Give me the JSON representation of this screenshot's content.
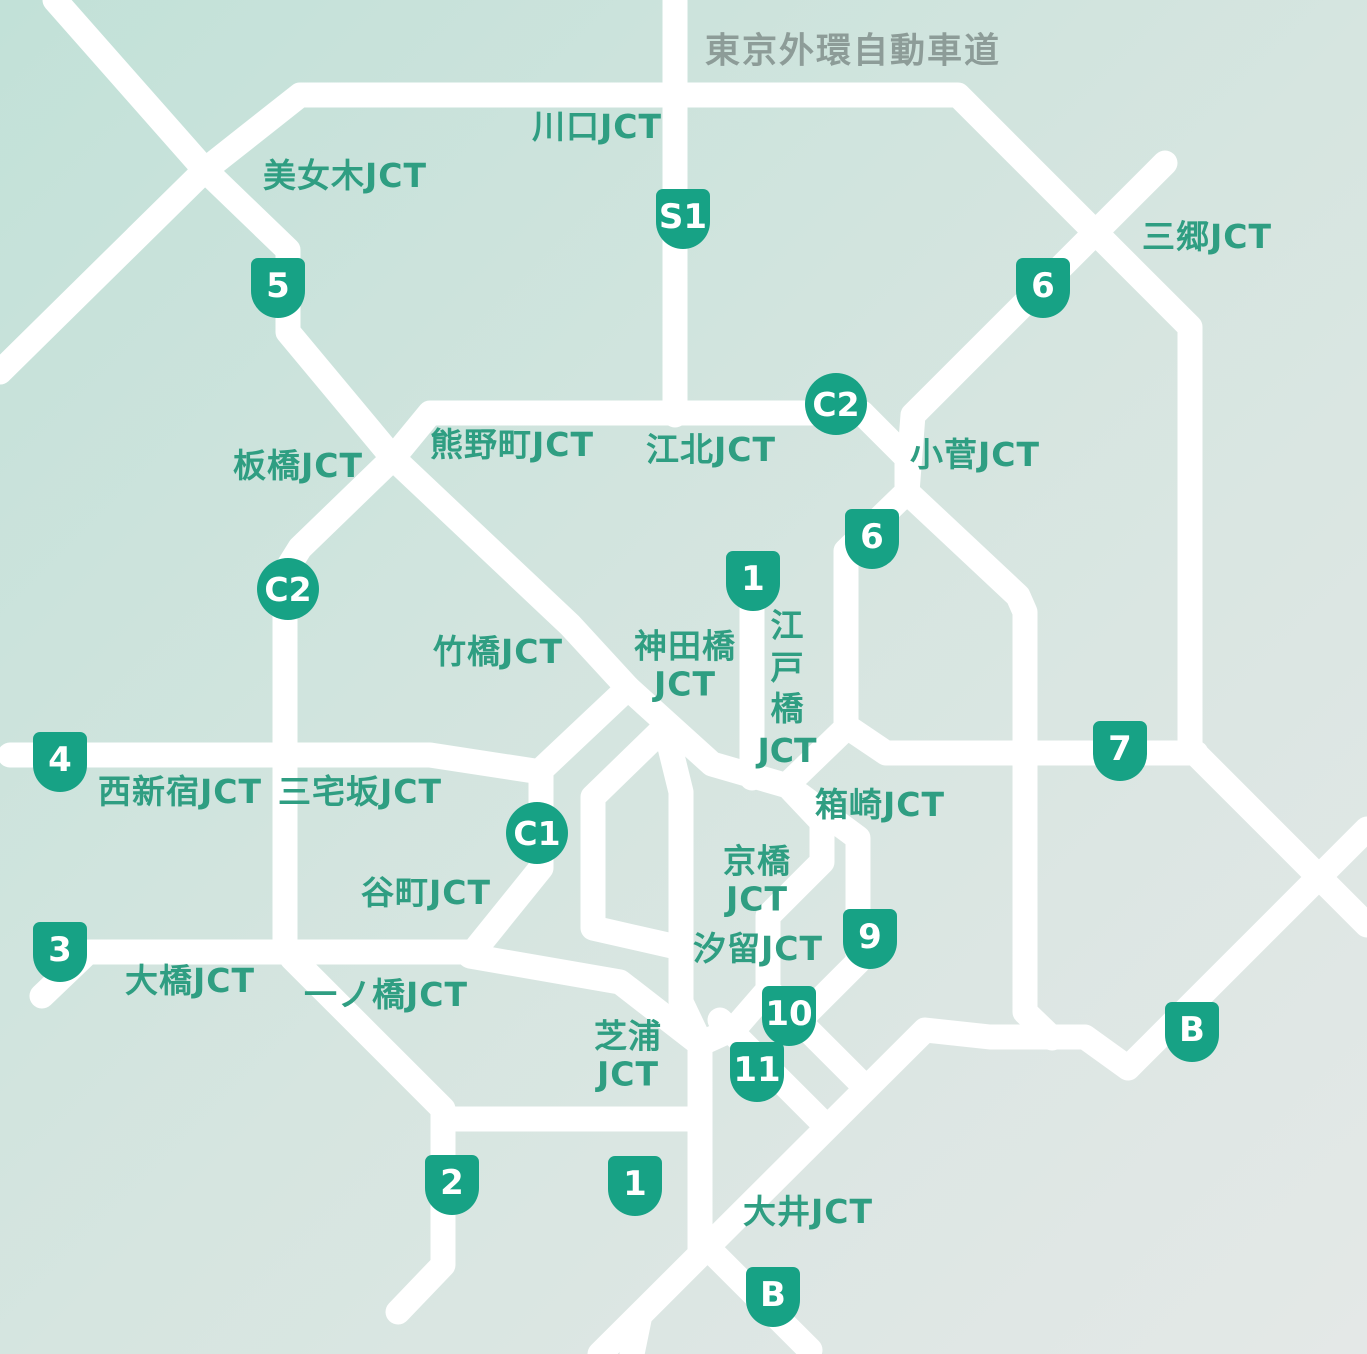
{
  "map": {
    "title": {
      "text": "東京外環自動車道",
      "x": 853,
      "y": 48
    },
    "junction_labels": [
      {
        "name": "kawaguchi-jct",
        "lines": [
          "川口JCT"
        ],
        "x": 597,
        "y": 127,
        "orientation": "horizontal"
      },
      {
        "name": "bijogi-jct",
        "lines": [
          "美女木JCT"
        ],
        "x": 345,
        "y": 176,
        "orientation": "horizontal"
      },
      {
        "name": "misato-jct",
        "lines": [
          "三郷JCT"
        ],
        "x": 1207,
        "y": 237,
        "orientation": "horizontal"
      },
      {
        "name": "itabashi-jct",
        "lines": [
          "板橋JCT"
        ],
        "x": 298,
        "y": 466,
        "orientation": "horizontal"
      },
      {
        "name": "kumanocho-jct",
        "lines": [
          "熊野町JCT"
        ],
        "x": 512,
        "y": 445,
        "orientation": "horizontal"
      },
      {
        "name": "kohoku-jct",
        "lines": [
          "江北JCT"
        ],
        "x": 711,
        "y": 450,
        "orientation": "horizontal"
      },
      {
        "name": "kosuge-jct",
        "lines": [
          "小菅JCT"
        ],
        "x": 975,
        "y": 455,
        "orientation": "horizontal"
      },
      {
        "name": "takebashi-jct",
        "lines": [
          "竹橋JCT"
        ],
        "x": 498,
        "y": 652,
        "orientation": "horizontal"
      },
      {
        "name": "kandabashi-jct",
        "lines": [
          "神田橋",
          "JCT"
        ],
        "x": 685,
        "y": 665,
        "orientation": "horizontal"
      },
      {
        "name": "edobashi-jct",
        "lines": [
          "江",
          "戸",
          "橋",
          "JCT"
        ],
        "x": 787,
        "y": 688,
        "orientation": "vertical"
      },
      {
        "name": "nishishinjuku-jct",
        "lines": [
          "西新宿JCT"
        ],
        "x": 180,
        "y": 792,
        "orientation": "horizontal"
      },
      {
        "name": "miyakezaka-jct",
        "lines": [
          "三宅坂JCT"
        ],
        "x": 360,
        "y": 792,
        "orientation": "horizontal"
      },
      {
        "name": "hakozaki-jct",
        "lines": [
          "箱崎JCT"
        ],
        "x": 880,
        "y": 805,
        "orientation": "horizontal"
      },
      {
        "name": "tanimachi-jct",
        "lines": [
          "谷町JCT"
        ],
        "x": 426,
        "y": 893,
        "orientation": "horizontal"
      },
      {
        "name": "kyobashi-jct",
        "lines": [
          "京橋",
          "JCT"
        ],
        "x": 757,
        "y": 880,
        "orientation": "horizontal"
      },
      {
        "name": "shiodome-jct",
        "lines": [
          "汐留JCT"
        ],
        "x": 758,
        "y": 949,
        "orientation": "horizontal"
      },
      {
        "name": "ohashi-jct",
        "lines": [
          "大橋JCT"
        ],
        "x": 190,
        "y": 981,
        "orientation": "horizontal"
      },
      {
        "name": "ichinohashi-jct",
        "lines": [
          "一ノ橋JCT"
        ],
        "x": 386,
        "y": 995,
        "orientation": "horizontal"
      },
      {
        "name": "shibaura-jct",
        "lines": [
          "芝浦",
          "JCT"
        ],
        "x": 628,
        "y": 1055,
        "orientation": "horizontal"
      },
      {
        "name": "oi-jct",
        "lines": [
          "大井JCT"
        ],
        "x": 808,
        "y": 1212,
        "orientation": "horizontal"
      }
    ],
    "route_badges": [
      {
        "label": "S1",
        "shape": "shield",
        "x": 683,
        "y": 219
      },
      {
        "label": "5",
        "shape": "shield",
        "x": 278,
        "y": 288
      },
      {
        "label": "6",
        "shape": "shield",
        "x": 1043,
        "y": 288
      },
      {
        "label": "C2",
        "shape": "circle",
        "x": 836,
        "y": 404
      },
      {
        "label": "6",
        "shape": "shield",
        "x": 872,
        "y": 539
      },
      {
        "label": "1",
        "shape": "shield",
        "x": 753,
        "y": 581
      },
      {
        "label": "C2",
        "shape": "circle",
        "x": 288,
        "y": 589
      },
      {
        "label": "7",
        "shape": "shield",
        "x": 1120,
        "y": 751
      },
      {
        "label": "4",
        "shape": "shield",
        "x": 60,
        "y": 762
      },
      {
        "label": "C1",
        "shape": "circle",
        "x": 537,
        "y": 833
      },
      {
        "label": "9",
        "shape": "shield",
        "x": 870,
        "y": 939
      },
      {
        "label": "3",
        "shape": "shield",
        "x": 60,
        "y": 952
      },
      {
        "label": "10",
        "shape": "shield",
        "x": 789,
        "y": 1016
      },
      {
        "label": "B",
        "shape": "shield",
        "x": 1192,
        "y": 1032
      },
      {
        "label": "11",
        "shape": "shield",
        "x": 757,
        "y": 1072
      },
      {
        "label": "2",
        "shape": "shield",
        "x": 452,
        "y": 1185
      },
      {
        "label": "1",
        "shape": "shield",
        "x": 635,
        "y": 1186
      },
      {
        "label": "B",
        "shape": "shield",
        "x": 773,
        "y": 1297
      }
    ],
    "colors": {
      "background_start": "#c2e1d8",
      "background_mid": "#d6e5e0",
      "background_end": "#e4e8e7",
      "road": "#ffffff",
      "label_green": "#2f9e82",
      "title_gray": "#8d9c98",
      "badge_green": "#17a285",
      "badge_text": "#ffffff"
    }
  }
}
